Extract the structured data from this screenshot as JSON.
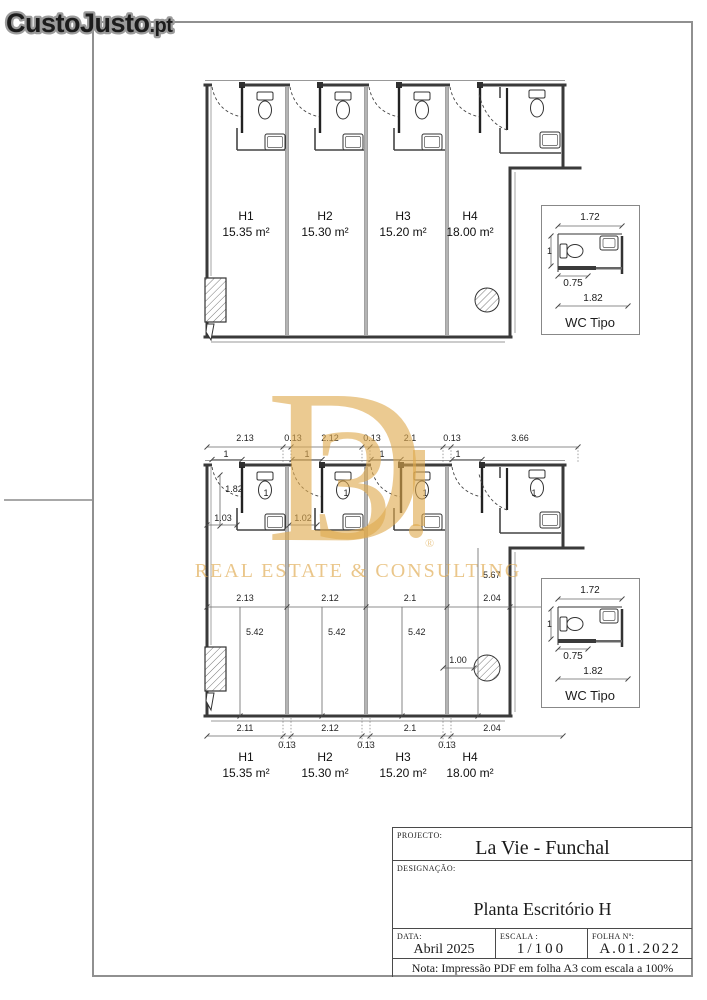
{
  "colors": {
    "watermark_gold": "#DFA94F",
    "wall_dark": "#3a3a3a",
    "frame_gray": "#909090",
    "logo_outline_gray": "#9b9b9b"
  },
  "logo": {
    "main": "CustoJusto",
    "tld": ".pt"
  },
  "watermark": {
    "letter": "D",
    "digit": "3",
    "registered": "®",
    "tagline": "REAL ESTATE & CONSULTING"
  },
  "rooms": [
    {
      "id": "H1",
      "area": "15.35 m²"
    },
    {
      "id": "H2",
      "area": "15.30 m²"
    },
    {
      "id": "H3",
      "area": "15.20 m²"
    },
    {
      "id": "H4",
      "area": "18.00 m²"
    }
  ],
  "wc_detail": {
    "label": "WC Tipo",
    "top_width": "1.72",
    "left_height": "1",
    "inner_width": "0.75",
    "bottom_width": "1.82"
  },
  "bottom_plan": {
    "top_dims": [
      "2.13",
      "0.13",
      "2.12",
      "0.13",
      "2.1",
      "0.13",
      "3.66"
    ],
    "door_dims": [
      "1",
      "1",
      "1",
      "1"
    ],
    "entry_depth": "1.82",
    "entry_widths": [
      "1.03",
      "1.02"
    ],
    "wc_widths": [
      "1",
      "1",
      "1",
      "1"
    ],
    "mid_dims": [
      "2.13",
      "2.12",
      "2.1",
      "2.04"
    ],
    "depth_dims": [
      "5.42",
      "5.42",
      "5.42",
      "5.67"
    ],
    "column_dim": "1.00",
    "bottom_dims": [
      "2.11",
      "2.12",
      "2.1",
      "2.04"
    ],
    "gap_dims": [
      "0.13",
      "0.13",
      "0.13"
    ]
  },
  "title_block": {
    "project_label": "PROJECTO:",
    "project": "La Vie - Funchal",
    "designation_label": "DESIGNAÇÃO:",
    "designation": "Planta Escritório H",
    "date_label": "DATA:",
    "date": "Abril 2025",
    "scale_label": "ESCALA :",
    "scale": "1/100",
    "sheet_label": "FOLHA Nº:",
    "sheet": "A.01.2022",
    "note": "Nota: Impressão PDF em folha A3 com escala a 100%"
  }
}
